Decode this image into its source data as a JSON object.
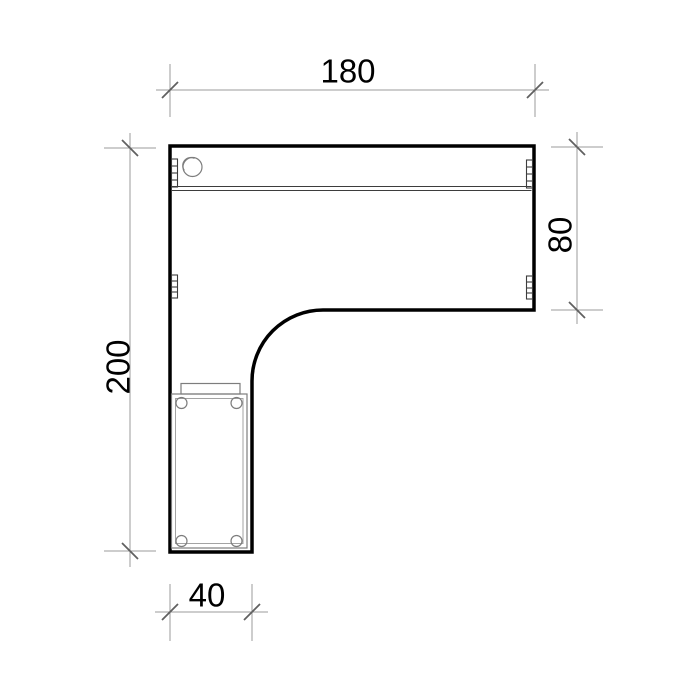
{
  "drawing": {
    "subject": "l-shaped-desk-plan-view",
    "dimensions": {
      "top": "180",
      "right": "80",
      "left": "200",
      "bottom": "40"
    },
    "style": {
      "background": "#ffffff",
      "outline_color": "#000000",
      "dimension_line_color": "#9b9b9b",
      "tick_color": "#606060",
      "detail_color": "#7d7d7d",
      "text_color": "#000000"
    }
  }
}
